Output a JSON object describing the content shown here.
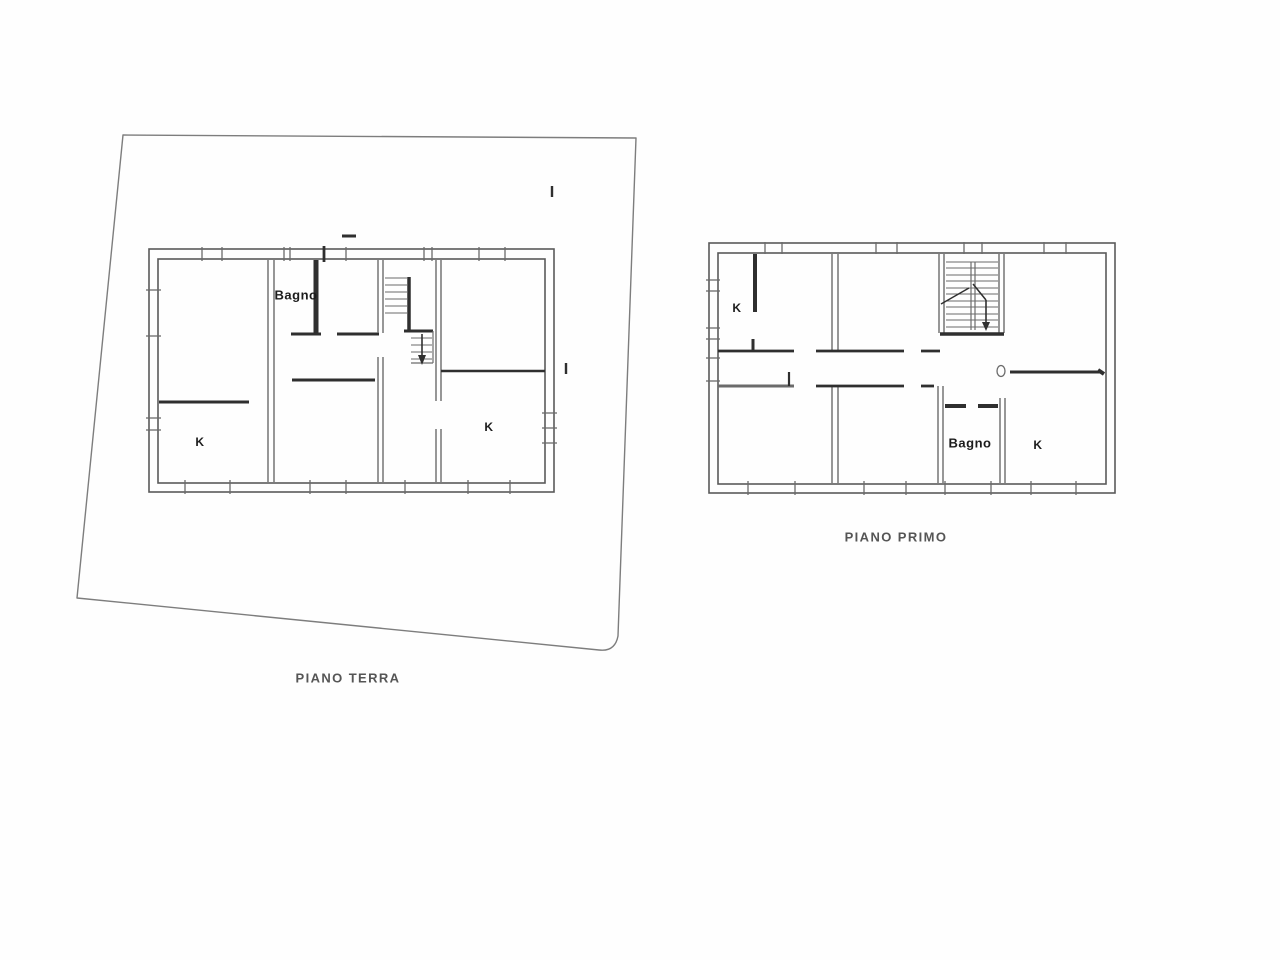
{
  "canvas": {
    "width": 1280,
    "height": 960,
    "background": "#fefefe"
  },
  "colors": {
    "dark": "#2f2f2f",
    "mid": "#6b6b6b",
    "light": "#9a9a9a",
    "outline": "#5a5a5a",
    "parcel": "#7d7d7d",
    "label_text": "#1c1c1c",
    "title_text": "#555555"
  },
  "plans": [
    {
      "id": "piano-terra",
      "title": "PIANO TERRA",
      "title_pos": {
        "x": 348,
        "y": 678
      },
      "paths": [
        {
          "d": "M123,135 L636,138 L618,636 Q615,652 599,650 L77,598 Z",
          "w": 1.4,
          "shade": "parcel",
          "name": "parcel-boundary"
        }
      ],
      "rects": [
        {
          "x": 149,
          "y": 249,
          "w": 405,
          "h": 243,
          "sw": 1.6,
          "shade": "outline",
          "name": "building-outer-wall"
        },
        {
          "x": 158,
          "y": 259,
          "w": 387,
          "h": 224,
          "sw": 1.6,
          "shade": "outline",
          "name": "building-inner-wall"
        }
      ],
      "lines": [
        [
          268,
          260,
          268,
          482,
          1.4,
          "mid"
        ],
        [
          274,
          260,
          274,
          482,
          1.4,
          "mid"
        ],
        [
          159,
          402,
          249,
          402,
          3,
          "dark"
        ],
        [
          316,
          260,
          316,
          334,
          5,
          "dark"
        ],
        [
          291,
          334,
          321,
          334,
          3,
          "dark"
        ],
        [
          337,
          334,
          379,
          334,
          3,
          "dark"
        ],
        [
          378,
          260,
          378,
          333,
          1.4,
          "mid"
        ],
        [
          383,
          260,
          383,
          333,
          1.4,
          "mid"
        ],
        [
          378,
          357,
          378,
          482,
          1.4,
          "mid"
        ],
        [
          383,
          357,
          383,
          482,
          1.4,
          "mid"
        ],
        [
          292,
          380,
          375,
          380,
          3,
          "dark"
        ],
        [
          436,
          260,
          436,
          401,
          1.4,
          "mid"
        ],
        [
          441,
          260,
          441,
          401,
          1.4,
          "mid"
        ],
        [
          436,
          429,
          436,
          482,
          1.4,
          "mid"
        ],
        [
          441,
          429,
          441,
          482,
          1.4,
          "mid"
        ],
        [
          441,
          371,
          545,
          371,
          2.6,
          "dark"
        ],
        [
          385,
          278,
          407,
          278,
          1.1,
          "mid"
        ],
        [
          385,
          285,
          407,
          285,
          1.1,
          "mid"
        ],
        [
          385,
          292,
          407,
          292,
          1.1,
          "mid"
        ],
        [
          385,
          299,
          407,
          299,
          1.1,
          "mid"
        ],
        [
          385,
          306,
          407,
          306,
          1.1,
          "mid"
        ],
        [
          385,
          313,
          407,
          313,
          1.1,
          "mid"
        ],
        [
          409,
          277,
          409,
          331,
          3.5,
          "dark"
        ],
        [
          404,
          331,
          433,
          331,
          3,
          "dark"
        ],
        [
          411,
          338,
          432,
          338,
          1.1,
          "mid"
        ],
        [
          411,
          345,
          432,
          345,
          1.1,
          "mid"
        ],
        [
          411,
          352,
          432,
          352,
          1.1,
          "mid"
        ],
        [
          411,
          359,
          432,
          359,
          1.1,
          "mid"
        ],
        [
          433,
          331,
          433,
          363,
          1.2,
          "mid"
        ],
        [
          411,
          363,
          433,
          363,
          1.2,
          "mid"
        ],
        [
          422,
          334,
          422,
          357,
          1.6,
          "dark"
        ],
        [
          202,
          247,
          202,
          261,
          1.3,
          "mid"
        ],
        [
          222,
          247,
          222,
          261,
          1.3,
          "mid"
        ],
        [
          284,
          247,
          284,
          261,
          1.3,
          "mid"
        ],
        [
          290,
          247,
          290,
          261,
          1.3,
          "mid"
        ],
        [
          346,
          247,
          346,
          261,
          1.3,
          "mid"
        ],
        [
          424,
          247,
          424,
          261,
          1.3,
          "mid"
        ],
        [
          432,
          247,
          432,
          261,
          1.3,
          "mid"
        ],
        [
          479,
          247,
          479,
          261,
          1.3,
          "mid"
        ],
        [
          505,
          247,
          505,
          261,
          1.3,
          "mid"
        ],
        [
          324,
          246,
          324,
          262,
          2.8,
          "dark"
        ],
        [
          146,
          290,
          161,
          290,
          1.3,
          "mid"
        ],
        [
          146,
          336,
          161,
          336,
          1.3,
          "mid"
        ],
        [
          146,
          418,
          161,
          418,
          1.3,
          "mid"
        ],
        [
          146,
          430,
          161,
          430,
          1.3,
          "mid"
        ],
        [
          542,
          413,
          557,
          413,
          1.3,
          "mid"
        ],
        [
          542,
          428,
          557,
          428,
          1.3,
          "mid"
        ],
        [
          542,
          443,
          557,
          443,
          1.3,
          "mid"
        ],
        [
          185,
          480,
          185,
          494,
          1.3,
          "mid"
        ],
        [
          230,
          480,
          230,
          494,
          1.3,
          "mid"
        ],
        [
          310,
          480,
          310,
          494,
          1.3,
          "mid"
        ],
        [
          346,
          480,
          346,
          494,
          1.3,
          "mid"
        ],
        [
          405,
          480,
          405,
          494,
          1.3,
          "mid"
        ],
        [
          468,
          480,
          468,
          494,
          1.3,
          "mid"
        ],
        [
          510,
          480,
          510,
          494,
          1.3,
          "mid"
        ],
        [
          342,
          236,
          356,
          236,
          3,
          "dark"
        ],
        [
          552,
          186,
          552,
          197,
          2.4,
          "dark"
        ],
        [
          566,
          363,
          566,
          374,
          2.4,
          "dark"
        ]
      ],
      "polys": [
        {
          "points": "418,355 426,355 422,365",
          "shade": "dark",
          "name": "stair-arrow-head"
        }
      ],
      "ellipses": [],
      "rooms": [
        {
          "label": "Bagno",
          "x": 296,
          "y": 295,
          "cls": "big"
        },
        {
          "label": "K",
          "x": 200,
          "y": 442,
          "cls": "small"
        },
        {
          "label": "K",
          "x": 489,
          "y": 427,
          "cls": "small"
        }
      ]
    },
    {
      "id": "piano-primo",
      "title": "PIANO PRIMO",
      "title_pos": {
        "x": 896,
        "y": 537
      },
      "paths": [],
      "rects": [
        {
          "x": 709,
          "y": 243,
          "w": 406,
          "h": 250,
          "sw": 1.6,
          "shade": "outline",
          "name": "building-outer-wall"
        },
        {
          "x": 718,
          "y": 253,
          "w": 388,
          "h": 231,
          "sw": 1.6,
          "shade": "outline",
          "name": "building-inner-wall"
        }
      ],
      "lines": [
        [
          832,
          254,
          832,
          350,
          1.4,
          "mid"
        ],
        [
          838,
          254,
          838,
          350,
          1.4,
          "mid"
        ],
        [
          832,
          386,
          832,
          483,
          1.4,
          "mid"
        ],
        [
          838,
          386,
          838,
          483,
          1.4,
          "mid"
        ],
        [
          939,
          254,
          939,
          333,
          1.4,
          "mid"
        ],
        [
          944,
          254,
          944,
          333,
          1.4,
          "mid"
        ],
        [
          999,
          254,
          999,
          333,
          1.4,
          "mid"
        ],
        [
          1004,
          254,
          1004,
          333,
          1.4,
          "mid"
        ],
        [
          938,
          386,
          938,
          483,
          1.4,
          "mid"
        ],
        [
          943,
          386,
          943,
          483,
          1.4,
          "mid"
        ],
        [
          1000,
          398,
          1000,
          483,
          1.4,
          "mid"
        ],
        [
          1005,
          398,
          1005,
          483,
          1.4,
          "mid"
        ],
        [
          718,
          351,
          794,
          351,
          2.8,
          "dark"
        ],
        [
          816,
          351,
          904,
          351,
          2.8,
          "dark"
        ],
        [
          921,
          351,
          940,
          351,
          2.8,
          "dark"
        ],
        [
          753,
          339,
          753,
          352,
          3,
          "dark"
        ],
        [
          755,
          254,
          755,
          312,
          4,
          "dark"
        ],
        [
          718,
          386,
          794,
          386,
          3,
          "mid"
        ],
        [
          816,
          386,
          904,
          386,
          2.8,
          "dark"
        ],
        [
          921,
          386,
          934,
          386,
          2.8,
          "dark"
        ],
        [
          789,
          372,
          789,
          386,
          2.2,
          "dark"
        ],
        [
          945,
          406,
          966,
          406,
          4,
          "dark"
        ],
        [
          978,
          406,
          998,
          406,
          4,
          "dark"
        ],
        [
          1010,
          372,
          1100,
          372,
          3,
          "dark"
        ],
        [
          1098,
          370,
          1104,
          374,
          4,
          "dark"
        ],
        [
          940,
          334,
          1004,
          334,
          3.5,
          "dark"
        ],
        [
          946,
          262,
          998,
          262,
          1.1,
          "mid"
        ],
        [
          946,
          268,
          998,
          268,
          1.1,
          "mid"
        ],
        [
          946,
          275,
          998,
          275,
          1.1,
          "mid"
        ],
        [
          946,
          281,
          998,
          281,
          1.1,
          "mid"
        ],
        [
          946,
          288,
          998,
          288,
          1.1,
          "mid"
        ],
        [
          946,
          294,
          998,
          294,
          1.1,
          "mid"
        ],
        [
          946,
          301,
          998,
          301,
          1.1,
          "mid"
        ],
        [
          946,
          307,
          998,
          307,
          1.1,
          "mid"
        ],
        [
          946,
          314,
          998,
          314,
          1.1,
          "mid"
        ],
        [
          946,
          320,
          998,
          320,
          1.1,
          "mid"
        ],
        [
          946,
          327,
          998,
          327,
          1.1,
          "mid"
        ],
        [
          971,
          262,
          971,
          330,
          1.2,
          "mid"
        ],
        [
          975,
          262,
          975,
          330,
          1.2,
          "mid"
        ],
        [
          941,
          304,
          969,
          288,
          1.4,
          "dark"
        ],
        [
          973,
          284,
          986,
          300,
          1.5,
          "dark"
        ],
        [
          986,
          300,
          986,
          324,
          1.6,
          "dark"
        ],
        [
          765,
          242,
          765,
          254,
          1.3,
          "mid"
        ],
        [
          782,
          242,
          782,
          254,
          1.3,
          "mid"
        ],
        [
          876,
          242,
          876,
          254,
          1.3,
          "mid"
        ],
        [
          897,
          242,
          897,
          254,
          1.3,
          "mid"
        ],
        [
          964,
          242,
          964,
          254,
          1.3,
          "mid"
        ],
        [
          982,
          242,
          982,
          254,
          1.3,
          "mid"
        ],
        [
          1044,
          242,
          1044,
          254,
          1.3,
          "mid"
        ],
        [
          1066,
          242,
          1066,
          254,
          1.3,
          "mid"
        ],
        [
          706,
          280,
          720,
          280,
          1.3,
          "mid"
        ],
        [
          706,
          291,
          720,
          291,
          1.3,
          "mid"
        ],
        [
          706,
          328,
          720,
          328,
          1.3,
          "mid"
        ],
        [
          706,
          339,
          720,
          339,
          1.3,
          "mid"
        ],
        [
          706,
          358,
          720,
          358,
          1.3,
          "mid"
        ],
        [
          706,
          381,
          720,
          381,
          1.3,
          "mid"
        ],
        [
          748,
          481,
          748,
          495,
          1.3,
          "mid"
        ],
        [
          795,
          481,
          795,
          495,
          1.3,
          "mid"
        ],
        [
          864,
          481,
          864,
          495,
          1.3,
          "mid"
        ],
        [
          906,
          481,
          906,
          495,
          1.3,
          "mid"
        ],
        [
          945,
          481,
          945,
          495,
          1.3,
          "mid"
        ],
        [
          991,
          481,
          991,
          495,
          1.3,
          "mid"
        ],
        [
          1031,
          481,
          1031,
          495,
          1.3,
          "mid"
        ],
        [
          1076,
          481,
          1076,
          495,
          1.3,
          "mid"
        ]
      ],
      "polys": [
        {
          "points": "982,322 990,322 986,331",
          "shade": "dark",
          "name": "stair-arrow-head"
        }
      ],
      "ellipses": [
        {
          "cx": 1001,
          "cy": 371,
          "rx": 4,
          "ry": 5.5,
          "sw": 1.3,
          "shade": "mid",
          "name": "door-pivot-circle"
        }
      ],
      "rooms": [
        {
          "label": "K",
          "x": 737,
          "y": 308,
          "cls": "small"
        },
        {
          "label": "Bagno",
          "x": 970,
          "y": 443,
          "cls": "big"
        },
        {
          "label": "K",
          "x": 1038,
          "y": 445,
          "cls": "small"
        }
      ]
    }
  ]
}
